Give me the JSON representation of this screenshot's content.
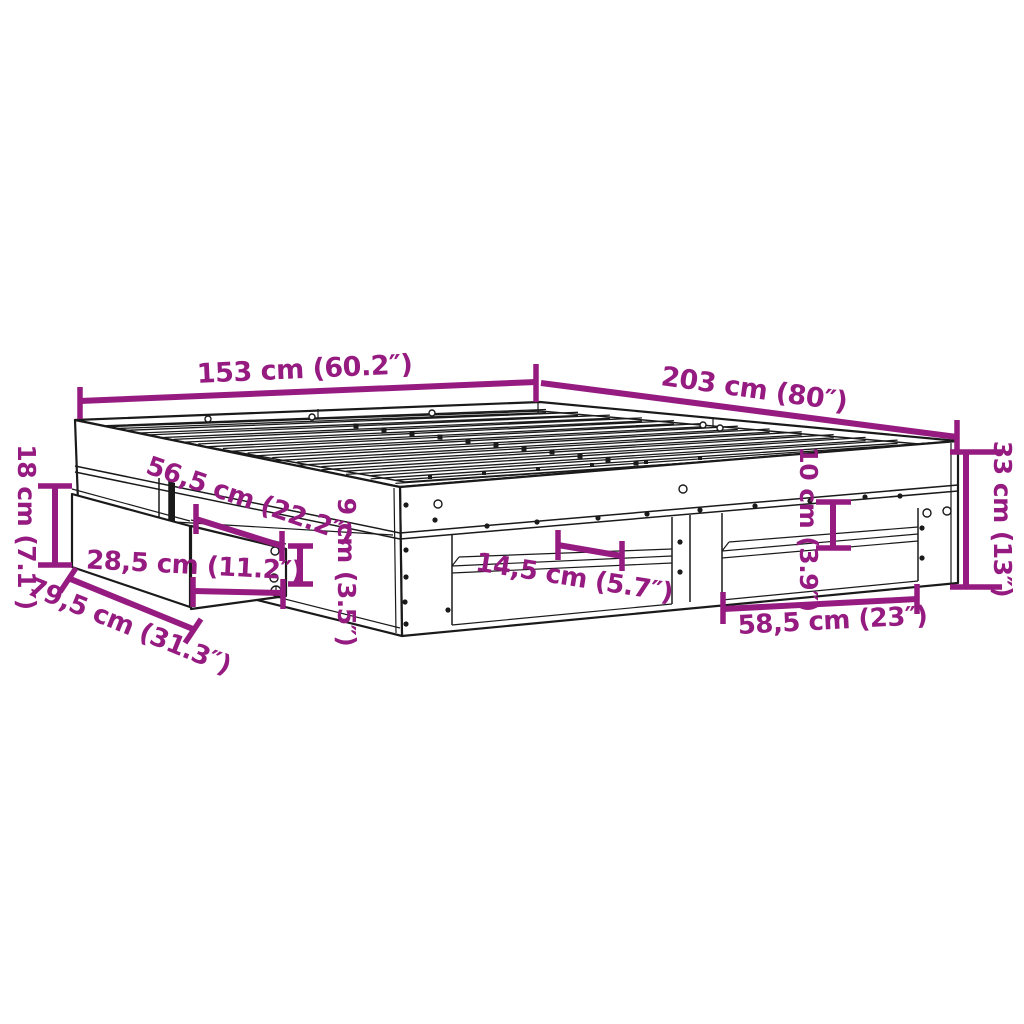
{
  "diagram": {
    "type": "product-dimension-diagram",
    "subject": "bed frame with pull-out drawer and open storage shelves, isometric line drawing",
    "background_color": "#ffffff",
    "outline_color": "#1a1a1a",
    "dimension_color": "#951b81",
    "dims": {
      "width": "153 cm (60.2″)",
      "length": "203 cm (80″)",
      "frame_height": "33 cm (13″)",
      "drawer_front_height": "18 cm (7.1″)",
      "drawer_front_width": "79,5 cm (31.3″)",
      "drawer_depth": "56,5 cm (22.2″)",
      "drawer_inner_width": "28,5 cm (11.2″)",
      "drawer_side_height": "9 cm (3.5″)",
      "shelf_depth": "14,5 cm (5.7″)",
      "shelf_opening_height": "10 cm (3.9″)",
      "shelf_opening_width": "58,5 cm (23″)"
    }
  }
}
